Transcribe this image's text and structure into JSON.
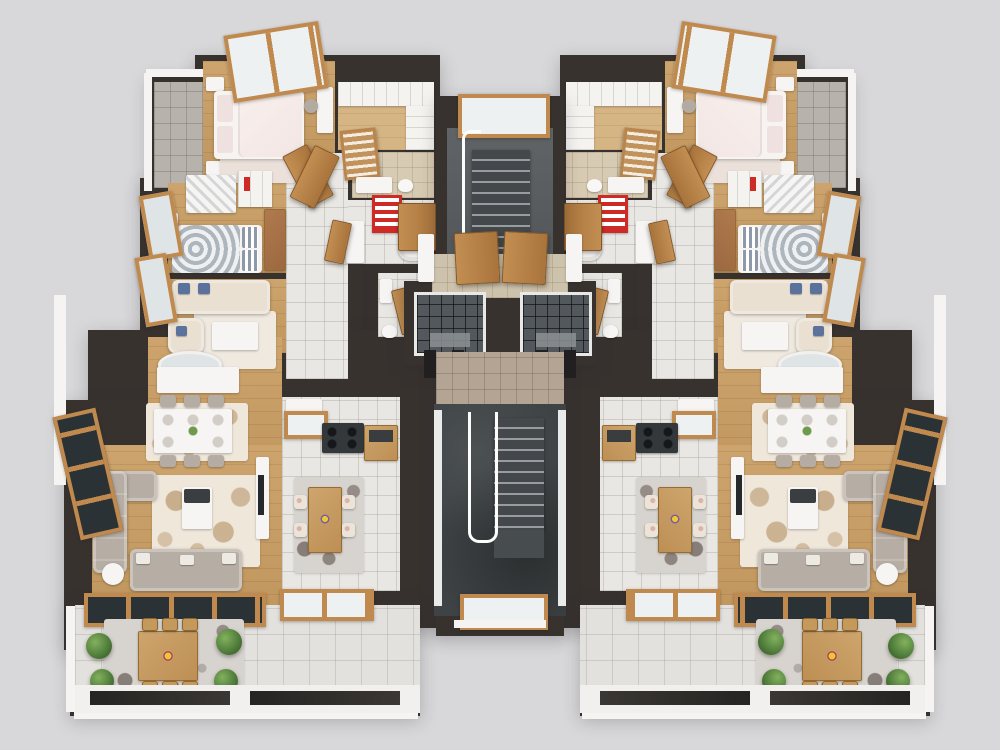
{
  "scene": {
    "description": "3D rendered top-down floor plan of one storey of a residential building: two mirrored three-room apartments flanking a central core with staircases and two elevators, terraces at the bottom, no visible text",
    "view": "top-down 3D architectural render",
    "background_color": "#d8d8da"
  },
  "palette": {
    "background": "#d8d8da",
    "wall_dark": "#38322f",
    "wall_face_white": "#f5f4f2",
    "wood_floor": "#c79e66",
    "wood_frame": "#c08a4e",
    "door_wood": "#b9854c",
    "tile_white": "#e9e7e3",
    "tile_beige": "#d8cbb3",
    "tile_gray": "#b7b2ac",
    "stair_slate": "#3e4345",
    "sofa_gray": "#b6ada4",
    "sofa_cream": "#e9e0d2",
    "accent_red": "#ce2a26",
    "accent_blue": "#5b739c",
    "plant_green": "#4e7a3a",
    "rug_floral": "#ad8858",
    "elevator_cab": "#53585c"
  },
  "building": {
    "apartments": [
      {
        "id": "left",
        "position": "west half",
        "rooms": [
          {
            "name": "master bedroom",
            "furniture": [
              "double bed with pink-white bedding",
              "two nightstands",
              "rug",
              "vanity desk with chair",
              "tilted roof window"
            ]
          },
          {
            "name": "side balcony",
            "furniture": [
              "gray stone tile floor"
            ]
          },
          {
            "name": "walk-in closet",
            "furniture": [
              "white shelving units",
              "louvered wardrobe door"
            ]
          },
          {
            "name": "en-suite bathroom",
            "furniture": [
              "vanity sink",
              "toilet"
            ]
          },
          {
            "name": "main bathroom",
            "furniture": [
              "bathtub",
              "red towel ladder",
              "vanity"
            ]
          },
          {
            "name": "second bedroom",
            "furniture": [
              "single bed with swirl duvet",
              "striped pillows",
              "patterned wardrobe",
              "bookshelf with red books",
              "wooden bench",
              "bedside table with bust"
            ]
          },
          {
            "name": "sitting room",
            "furniture": [
              "cream sofa with blue pillows",
              "armchair",
              "coffee table",
              "rug"
            ]
          },
          {
            "name": "hallway",
            "furniture": [
              "double wooden doors",
              "bathroom door"
            ]
          },
          {
            "name": "guest wc",
            "furniture": [
              "sink",
              "toilet",
              "wooden door"
            ]
          },
          {
            "name": "dining area",
            "furniture": [
              "oval mirror",
              "white buffet console",
              "dining table with six chairs",
              "floral rug"
            ]
          },
          {
            "name": "living room",
            "furniture": [
              "corner sofa",
              "two-seat sofa",
              "coffee table with dark tray",
              "round side table",
              "tv console",
              "floral rug",
              "window wall",
              "sliding terrace door"
            ]
          },
          {
            "name": "kitchen",
            "furniture": [
              "white counter",
              "pass-through window",
              "dark cooktop unit",
              "wooden cabinet",
              "wooden table with four chairs",
              "gray rug",
              "window"
            ]
          },
          {
            "name": "terrace",
            "furniture": [
              "wooden dining table with six chairs",
              "speckled rug with dark floral patches",
              "four green shrubs",
              "glass parapet panels"
            ]
          }
        ]
      },
      {
        "id": "right",
        "position": "east half",
        "mirror_of": "left"
      }
    ],
    "core": {
      "rooms": [
        "upper stair hall",
        "elevator lobby",
        "entrance corridor",
        "lower stairwell"
      ],
      "elevators": 2,
      "upper_staircase_visible_treads": 10,
      "lower_staircase_visible_treads": 9,
      "windows": [
        "top stair window",
        "bottom stairwell window"
      ],
      "lobby_double_doors": 2,
      "apartment_entry_doors": 2
    }
  },
  "counts": {
    "apartments": 2,
    "elevators": 2,
    "terrace_plants_per_apartment": 4,
    "red_towel_ladders": 2,
    "roof_windows": 2
  }
}
